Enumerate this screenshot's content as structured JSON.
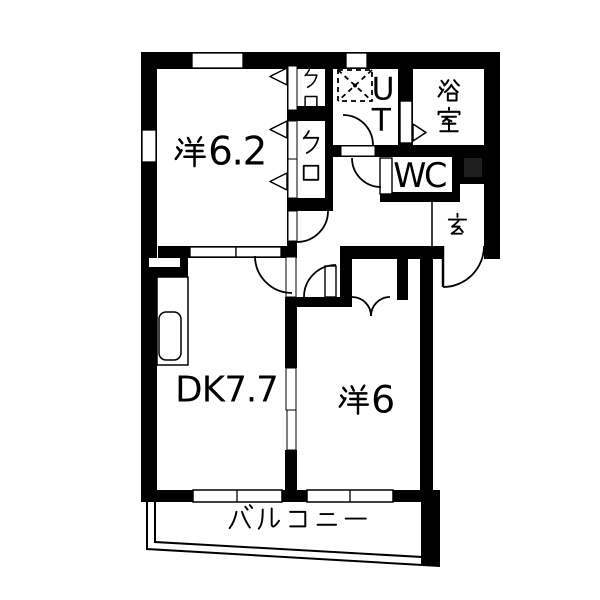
{
  "floor_plan": {
    "title": "apartment-floor-plan",
    "rooms": {
      "western_room_1": {
        "label": "洋6.2"
      },
      "closet_upper": {
        "label": "クロ"
      },
      "closet_lower": {
        "label": "クロ"
      },
      "utility": {
        "label": "UT"
      },
      "bathroom": {
        "label": "浴室"
      },
      "toilet": {
        "label": "WC"
      },
      "entrance": {
        "label": "玄"
      },
      "dining_kitchen": {
        "label": "DK7.7"
      },
      "western_room_2": {
        "label": "洋6"
      },
      "balcony": {
        "label": "バルコニー"
      }
    },
    "colors": {
      "wall": "#000000",
      "background": "#ffffff",
      "pipe_shaft": "#1e1e1e"
    }
  }
}
